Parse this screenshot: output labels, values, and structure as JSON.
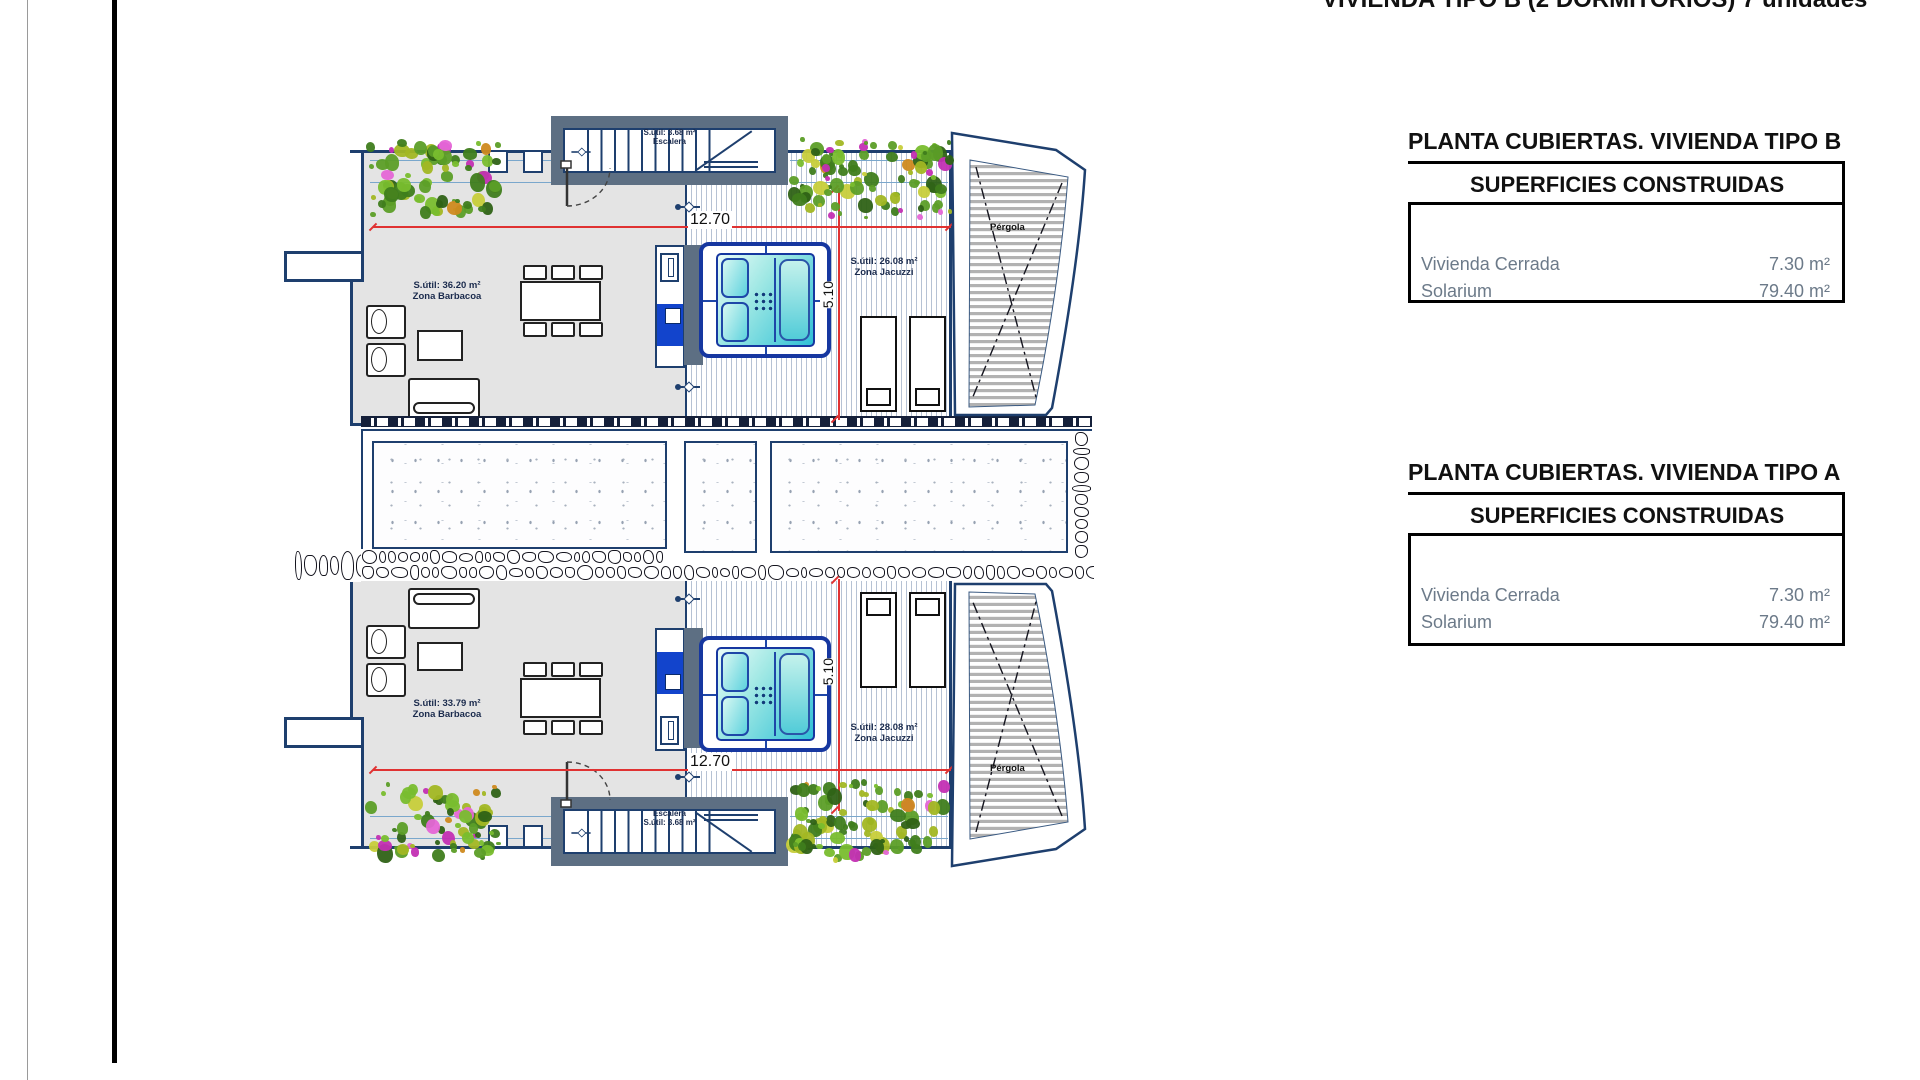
{
  "page": {
    "top_title": "VIVIENDA TIPO B (2 DORMITORIOS) 7 unidades"
  },
  "info_boxes": [
    {
      "title": "PLANTA CUBIERTAS. VIVIENDA TIPO B",
      "header": "SUPERFICIES CONSTRUIDAS",
      "rows": [
        {
          "label": "Vivienda Cerrada",
          "value": "7.30 m²"
        },
        {
          "label": "Solarium",
          "value": "79.40 m²"
        }
      ]
    },
    {
      "title": "PLANTA CUBIERTAS. VIVIENDA TIPO A",
      "header": "SUPERFICIES CONSTRUIDAS",
      "rows": [
        {
          "label": "Vivienda Cerrada",
          "value": "7.30 m²"
        },
        {
          "label": "Solarium",
          "value": "79.40 m²"
        }
      ]
    }
  ],
  "plan": {
    "units": [
      {
        "id": "tipo-b-top",
        "zona_barbacoa": {
          "area": "S.útil: 36.20 m²",
          "name": "Zona Barbacoa"
        },
        "zona_jacuzzi": {
          "area": "S.útil: 26.08 m²",
          "name": "Zona Jacuzzi"
        },
        "escalera": {
          "area": "S.útil: 3.68 m²",
          "name": "Escalera"
        },
        "dims": {
          "width": "12.70",
          "height": "5.10"
        },
        "pergola": "Pérgola"
      },
      {
        "id": "tipo-a-bottom",
        "zona_barbacoa": {
          "area": "S.útil: 33.79 m²",
          "name": "Zona Barbacoa"
        },
        "zona_jacuzzi": {
          "area": "S.útil: 28.08 m²",
          "name": "Zona Jacuzzi"
        },
        "escalera": {
          "area": "S.útil: 3.68 m²",
          "name": "Escalera"
        },
        "dims": {
          "width": "12.70",
          "height": "5.10"
        },
        "pergola": "Pérgola"
      }
    ]
  },
  "colors": {
    "wall": "#1e3f6e",
    "slate": "#5d6f83",
    "floor": "#e4e4e4",
    "deck_line": "#b6c2d4",
    "jacuzzi_frame": "#1637a0",
    "cabinet_blue": "#1244cc",
    "dim_red": "#e03232",
    "label_gray": "#6c7a89",
    "plan_label": "#1b2b4d"
  }
}
